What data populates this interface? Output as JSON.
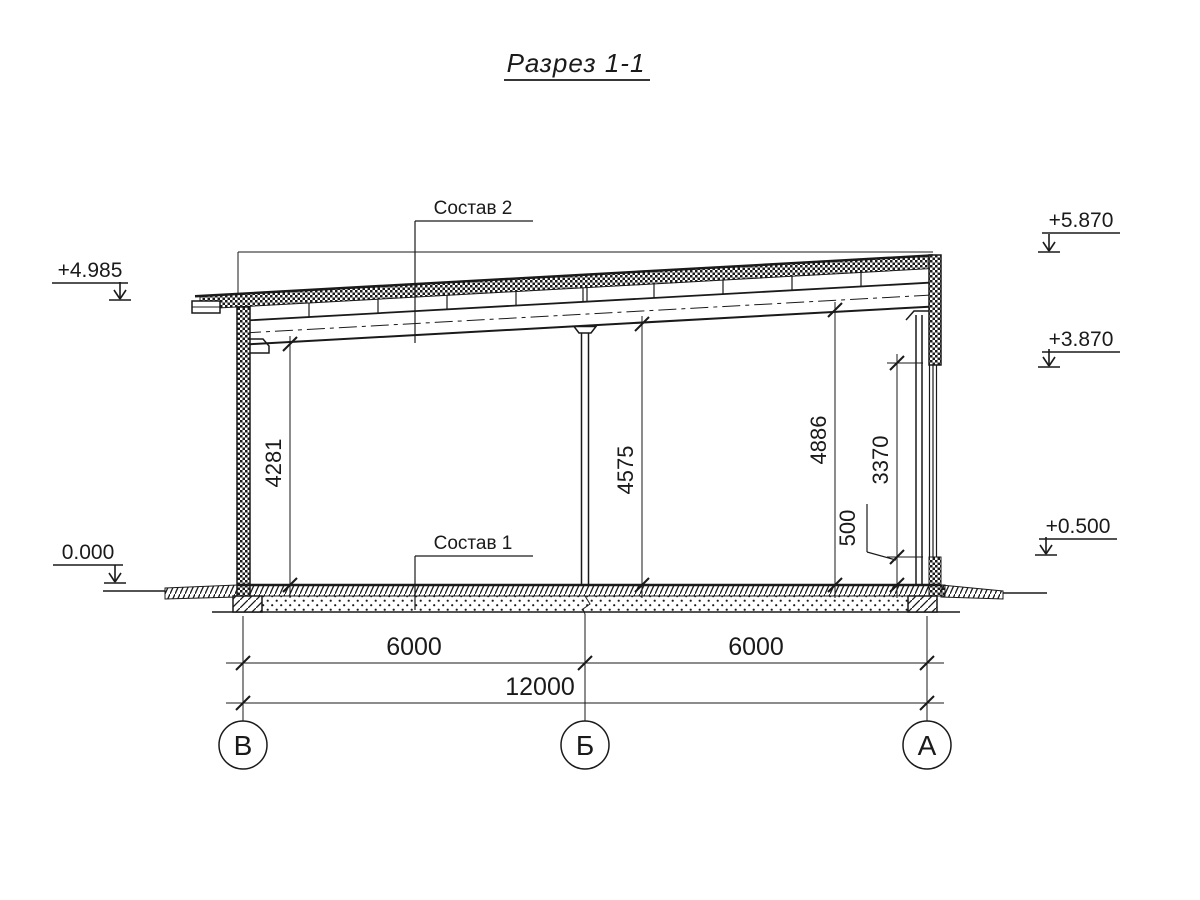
{
  "colors": {
    "ink": "#1a1a1a",
    "background": "#ffffff"
  },
  "drawing": {
    "title": "Разрез 1-1",
    "callouts": {
      "composition_2": "Состав 2",
      "composition_1": "Состав 1"
    },
    "elevation_marks": {
      "left_top": "+4.985",
      "left_zero": "0.000",
      "right_top": "+5.870",
      "right_mid": "+3.870",
      "right_low": "+0.500"
    },
    "vertical_dimensions": {
      "v_4281": "4281",
      "v_4575": "4575",
      "v_4886": "4886",
      "v_3370": "3370",
      "v_500": "500"
    },
    "horizontal_dimensions": {
      "span_left": "6000",
      "span_right": "6000",
      "total": "12000"
    },
    "axes": {
      "left": "В",
      "middle": "Б",
      "right": "А"
    }
  }
}
